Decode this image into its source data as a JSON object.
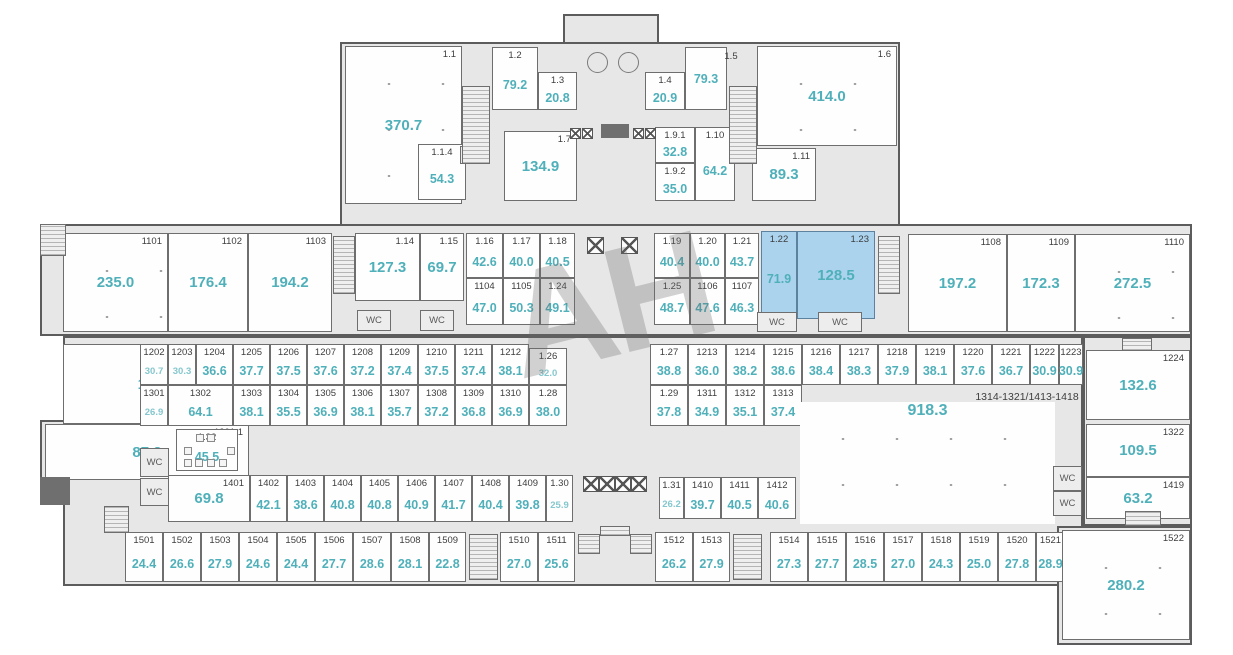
{
  "watermark": {
    "text": "АН"
  },
  "labels": {
    "wc": "WC"
  },
  "colors": {
    "area_text": "#4fb0ba",
    "area_text_small": "#85c7ce",
    "room_number_text": "#3d3d3d",
    "highlight_fill": "#abd3ee",
    "building_fill": "#e7e7e7",
    "wall": "#5c5c5c",
    "room_fill": "#fefefe"
  },
  "notes": [
    {
      "text": "1314-1321/1413-1418",
      "x": 1027,
      "y": 397
    }
  ],
  "base_shapes": [
    {
      "x": 563,
      "y": 14,
      "w": 96,
      "h": 34
    },
    {
      "x": 340,
      "y": 42,
      "w": 560,
      "h": 184
    },
    {
      "x": 40,
      "y": 224,
      "w": 1152,
      "h": 112
    },
    {
      "x": 63,
      "y": 336,
      "w": 1020,
      "h": 250
    },
    {
      "x": 1083,
      "y": 336,
      "w": 109,
      "h": 190
    },
    {
      "x": 1057,
      "y": 526,
      "w": 135,
      "h": 119
    },
    {
      "x": 40,
      "y": 420,
      "w": 30,
      "h": 85
    }
  ],
  "rooms": [
    {
      "n": "1.1",
      "a": "370.7",
      "x": 345,
      "y": 46,
      "w": 117,
      "h": 158,
      "s": "hall",
      "dots": true
    },
    {
      "n": "1.2",
      "a": "79.2",
      "x": 492,
      "y": 47,
      "w": 46,
      "h": 63,
      "s": "cell"
    },
    {
      "n": "1.3",
      "a": "20.8",
      "x": 538,
      "y": 72,
      "w": 39,
      "h": 38,
      "s": "cell"
    },
    {
      "n": "1.4",
      "a": "20.9",
      "x": 645,
      "y": 72,
      "w": 40,
      "h": 38,
      "s": "cell"
    },
    {
      "n": "",
      "a": "79.3",
      "x": 685,
      "y": 47,
      "w": 42,
      "h": 63,
      "s": "cell"
    },
    {
      "n": "1.5",
      "a": "",
      "x": 716,
      "y": 51,
      "w": 30,
      "h": 13,
      "s": "label"
    },
    {
      "n": "1.6",
      "a": "414.0",
      "x": 757,
      "y": 46,
      "w": 140,
      "h": 100,
      "s": "hall",
      "dots": true
    },
    {
      "n": "1.1.4",
      "a": "54.3",
      "x": 418,
      "y": 144,
      "w": 48,
      "h": 56,
      "s": "cell"
    },
    {
      "n": "1.7",
      "a": "134.9",
      "x": 504,
      "y": 131,
      "w": 73,
      "h": 70,
      "s": "hall"
    },
    {
      "n": "1.9.1",
      "a": "32.8",
      "x": 655,
      "y": 127,
      "w": 40,
      "h": 36,
      "s": "cell"
    },
    {
      "n": "1.9.2",
      "a": "35.0",
      "x": 655,
      "y": 163,
      "w": 40,
      "h": 38,
      "s": "cell"
    },
    {
      "n": "1.10",
      "a": "64.2",
      "x": 695,
      "y": 127,
      "w": 40,
      "h": 74,
      "s": "cell"
    },
    {
      "n": "1.11",
      "a": "89.3",
      "x": 752,
      "y": 148,
      "w": 64,
      "h": 53,
      "s": "hall"
    },
    {
      "n": "1101",
      "a": "235.0",
      "x": 63,
      "y": 233,
      "w": 105,
      "h": 99,
      "s": "hall",
      "dots": true
    },
    {
      "n": "1102",
      "a": "176.4",
      "x": 168,
      "y": 233,
      "w": 80,
      "h": 99,
      "s": "hall"
    },
    {
      "n": "1103",
      "a": "194.2",
      "x": 248,
      "y": 233,
      "w": 84,
      "h": 99,
      "s": "hall"
    },
    {
      "n": "1.14",
      "a": "127.3",
      "x": 355,
      "y": 233,
      "w": 65,
      "h": 68,
      "s": "hall"
    },
    {
      "n": "1.15",
      "a": "69.7",
      "x": 420,
      "y": 233,
      "w": 44,
      "h": 68,
      "s": "hall"
    },
    {
      "n": "1.16",
      "a": "42.6",
      "x": 466,
      "y": 233,
      "w": 37,
      "h": 45,
      "s": "cell"
    },
    {
      "n": "1.17",
      "a": "40.0",
      "x": 503,
      "y": 233,
      "w": 37,
      "h": 45,
      "s": "cell"
    },
    {
      "n": "1.18",
      "a": "40.5",
      "x": 540,
      "y": 233,
      "w": 35,
      "h": 45,
      "s": "cell"
    },
    {
      "n": "1104",
      "a": "47.0",
      "x": 466,
      "y": 278,
      "w": 37,
      "h": 47,
      "s": "cell"
    },
    {
      "n": "1105",
      "a": "50.3",
      "x": 503,
      "y": 278,
      "w": 37,
      "h": 47,
      "s": "cell"
    },
    {
      "n": "1.24",
      "a": "49.1",
      "x": 540,
      "y": 278,
      "w": 35,
      "h": 47,
      "s": "cell"
    },
    {
      "n": "1.19",
      "a": "40.4",
      "x": 654,
      "y": 233,
      "w": 36,
      "h": 45,
      "s": "cell"
    },
    {
      "n": "1.20",
      "a": "40.0",
      "x": 690,
      "y": 233,
      "w": 35,
      "h": 45,
      "s": "cell"
    },
    {
      "n": "1.21",
      "a": "43.7",
      "x": 725,
      "y": 233,
      "w": 34,
      "h": 45,
      "s": "cell"
    },
    {
      "n": "1.22",
      "a": "71.9",
      "x": 761,
      "y": 231,
      "w": 36,
      "h": 82,
      "s": "cell",
      "hl": true
    },
    {
      "n": "1.23",
      "a": "128.5",
      "x": 797,
      "y": 231,
      "w": 78,
      "h": 88,
      "s": "hall",
      "hl": true
    },
    {
      "n": "1.25",
      "a": "48.7",
      "x": 654,
      "y": 278,
      "w": 36,
      "h": 47,
      "s": "cell"
    },
    {
      "n": "1106",
      "a": "47.6",
      "x": 690,
      "y": 278,
      "w": 35,
      "h": 47,
      "s": "cell"
    },
    {
      "n": "1107",
      "a": "46.3",
      "x": 725,
      "y": 278,
      "w": 34,
      "h": 47,
      "s": "cell"
    },
    {
      "n": "1108",
      "a": "197.2",
      "x": 908,
      "y": 234,
      "w": 99,
      "h": 98,
      "s": "hall"
    },
    {
      "n": "1109",
      "a": "172.3",
      "x": 1007,
      "y": 234,
      "w": 68,
      "h": 98,
      "s": "hall"
    },
    {
      "n": "1110",
      "a": "272.5",
      "x": 1075,
      "y": 234,
      "w": 115,
      "h": 98,
      "s": "hall",
      "dots": true
    },
    {
      "n": "1201",
      "a": "117.8",
      "x": 63,
      "y": 344,
      "w": 186,
      "h": 80,
      "s": "hall"
    },
    {
      "n": "1201.1",
      "a": "87.2",
      "x": 45,
      "y": 424,
      "w": 204,
      "h": 56,
      "s": "hall"
    },
    {
      "n": "1202",
      "a": "30.7",
      "x": 140,
      "y": 344,
      "w": 28,
      "h": 41,
      "s": "cell",
      "small": true
    },
    {
      "n": "1203",
      "a": "30.3",
      "x": 168,
      "y": 344,
      "w": 28,
      "h": 41,
      "s": "cell",
      "small": true
    },
    {
      "n": "1204",
      "a": "36.6",
      "x": 196,
      "y": 344,
      "w": 37,
      "h": 41,
      "s": "cell"
    },
    {
      "n": "1205",
      "a": "37.7",
      "x": 233,
      "y": 344,
      "w": 37,
      "h": 41,
      "s": "cell"
    },
    {
      "n": "1206",
      "a": "37.5",
      "x": 270,
      "y": 344,
      "w": 37,
      "h": 41,
      "s": "cell"
    },
    {
      "n": "1207",
      "a": "37.6",
      "x": 307,
      "y": 344,
      "w": 37,
      "h": 41,
      "s": "cell"
    },
    {
      "n": "1208",
      "a": "37.2",
      "x": 344,
      "y": 344,
      "w": 37,
      "h": 41,
      "s": "cell"
    },
    {
      "n": "1209",
      "a": "37.4",
      "x": 381,
      "y": 344,
      "w": 37,
      "h": 41,
      "s": "cell"
    },
    {
      "n": "1210",
      "a": "37.5",
      "x": 418,
      "y": 344,
      "w": 37,
      "h": 41,
      "s": "cell"
    },
    {
      "n": "1211",
      "a": "37.4",
      "x": 455,
      "y": 344,
      "w": 37,
      "h": 41,
      "s": "cell"
    },
    {
      "n": "1212",
      "a": "38.1",
      "x": 492,
      "y": 344,
      "w": 37,
      "h": 41,
      "s": "cell"
    },
    {
      "n": "1.26",
      "a": "32.0",
      "x": 529,
      "y": 348,
      "w": 38,
      "h": 37,
      "s": "cell",
      "small": true
    },
    {
      "n": "1301",
      "a": "26.9",
      "x": 140,
      "y": 385,
      "w": 28,
      "h": 41,
      "s": "cell",
      "small": true
    },
    {
      "n": "1302",
      "a": "64.1",
      "x": 168,
      "y": 385,
      "w": 65,
      "h": 41,
      "s": "cell"
    },
    {
      "n": "1303",
      "a": "38.1",
      "x": 233,
      "y": 385,
      "w": 37,
      "h": 41,
      "s": "cell"
    },
    {
      "n": "1304",
      "a": "35.5",
      "x": 270,
      "y": 385,
      "w": 37,
      "h": 41,
      "s": "cell"
    },
    {
      "n": "1305",
      "a": "36.9",
      "x": 307,
      "y": 385,
      "w": 37,
      "h": 41,
      "s": "cell"
    },
    {
      "n": "1306",
      "a": "38.1",
      "x": 344,
      "y": 385,
      "w": 37,
      "h": 41,
      "s": "cell"
    },
    {
      "n": "1307",
      "a": "35.7",
      "x": 381,
      "y": 385,
      "w": 37,
      "h": 41,
      "s": "cell"
    },
    {
      "n": "1308",
      "a": "37.2",
      "x": 418,
      "y": 385,
      "w": 37,
      "h": 41,
      "s": "cell"
    },
    {
      "n": "1309",
      "a": "36.8",
      "x": 455,
      "y": 385,
      "w": 37,
      "h": 41,
      "s": "cell"
    },
    {
      "n": "1310",
      "a": "36.9",
      "x": 492,
      "y": 385,
      "w": 37,
      "h": 41,
      "s": "cell"
    },
    {
      "n": "1.28",
      "a": "38.0",
      "x": 529,
      "y": 385,
      "w": 38,
      "h": 41,
      "s": "cell"
    },
    {
      "n": "1.27",
      "a": "38.8",
      "x": 650,
      "y": 344,
      "w": 38,
      "h": 41,
      "s": "cell"
    },
    {
      "n": "1213",
      "a": "36.0",
      "x": 688,
      "y": 344,
      "w": 38,
      "h": 41,
      "s": "cell"
    },
    {
      "n": "1214",
      "a": "38.2",
      "x": 726,
      "y": 344,
      "w": 38,
      "h": 41,
      "s": "cell"
    },
    {
      "n": "1215",
      "a": "38.6",
      "x": 764,
      "y": 344,
      "w": 38,
      "h": 41,
      "s": "cell"
    },
    {
      "n": "1216",
      "a": "38.4",
      "x": 802,
      "y": 344,
      "w": 38,
      "h": 41,
      "s": "cell"
    },
    {
      "n": "1217",
      "a": "38.3",
      "x": 840,
      "y": 344,
      "w": 38,
      "h": 41,
      "s": "cell"
    },
    {
      "n": "1218",
      "a": "37.9",
      "x": 878,
      "y": 344,
      "w": 38,
      "h": 41,
      "s": "cell"
    },
    {
      "n": "1219",
      "a": "38.1",
      "x": 916,
      "y": 344,
      "w": 38,
      "h": 41,
      "s": "cell"
    },
    {
      "n": "1220",
      "a": "37.6",
      "x": 954,
      "y": 344,
      "w": 38,
      "h": 41,
      "s": "cell"
    },
    {
      "n": "1221",
      "a": "36.7",
      "x": 992,
      "y": 344,
      "w": 38,
      "h": 41,
      "s": "cell"
    },
    {
      "n": "1222",
      "a": "30.9",
      "x": 1030,
      "y": 344,
      "w": 29,
      "h": 41,
      "s": "cell"
    },
    {
      "n": "1223",
      "a": "30.9",
      "x": 1059,
      "y": 344,
      "w": 24,
      "h": 41,
      "s": "cell"
    },
    {
      "n": "1.29",
      "a": "37.8",
      "x": 650,
      "y": 385,
      "w": 38,
      "h": 41,
      "s": "cell"
    },
    {
      "n": "1311",
      "a": "34.9",
      "x": 688,
      "y": 385,
      "w": 38,
      "h": 41,
      "s": "cell"
    },
    {
      "n": "1312",
      "a": "35.1",
      "x": 726,
      "y": 385,
      "w": 38,
      "h": 41,
      "s": "cell"
    },
    {
      "n": "1313",
      "a": "37.4",
      "x": 764,
      "y": 385,
      "w": 38,
      "h": 41,
      "s": "cell"
    },
    {
      "n": "",
      "a": "918.3",
      "x": 800,
      "y": 402,
      "w": 255,
      "h": 122,
      "s": "open",
      "dots": true
    },
    {
      "n": "1224",
      "a": "132.6",
      "x": 1086,
      "y": 350,
      "w": 104,
      "h": 70,
      "s": "hall"
    },
    {
      "n": "1322",
      "a": "109.5",
      "x": 1086,
      "y": 424,
      "w": 104,
      "h": 53,
      "s": "hall"
    },
    {
      "n": "1419",
      "a": "63.2",
      "x": 1086,
      "y": 477,
      "w": 104,
      "h": 42,
      "s": "hall"
    },
    {
      "n": "1.32",
      "a": "45.5",
      "x": 176,
      "y": 429,
      "w": 62,
      "h": 42,
      "s": "cell"
    },
    {
      "n": "1401",
      "a": "69.8",
      "x": 168,
      "y": 475,
      "w": 82,
      "h": 47,
      "s": "hall"
    },
    {
      "n": "1402",
      "a": "42.1",
      "x": 250,
      "y": 475,
      "w": 37,
      "h": 47,
      "s": "cell"
    },
    {
      "n": "1403",
      "a": "38.6",
      "x": 287,
      "y": 475,
      "w": 37,
      "h": 47,
      "s": "cell"
    },
    {
      "n": "1404",
      "a": "40.8",
      "x": 324,
      "y": 475,
      "w": 37,
      "h": 47,
      "s": "cell"
    },
    {
      "n": "1405",
      "a": "40.8",
      "x": 361,
      "y": 475,
      "w": 37,
      "h": 47,
      "s": "cell"
    },
    {
      "n": "1406",
      "a": "40.9",
      "x": 398,
      "y": 475,
      "w": 37,
      "h": 47,
      "s": "cell"
    },
    {
      "n": "1407",
      "a": "41.7",
      "x": 435,
      "y": 475,
      "w": 37,
      "h": 47,
      "s": "cell"
    },
    {
      "n": "1408",
      "a": "40.4",
      "x": 472,
      "y": 475,
      "w": 37,
      "h": 47,
      "s": "cell"
    },
    {
      "n": "1409",
      "a": "39.8",
      "x": 509,
      "y": 475,
      "w": 37,
      "h": 47,
      "s": "cell"
    },
    {
      "n": "1.30",
      "a": "25.9",
      "x": 546,
      "y": 475,
      "w": 27,
      "h": 47,
      "s": "cell",
      "small": true
    },
    {
      "n": "1.31",
      "a": "26.2",
      "x": 659,
      "y": 477,
      "w": 25,
      "h": 42,
      "s": "cell",
      "small": true
    },
    {
      "n": "1410",
      "a": "39.7",
      "x": 684,
      "y": 477,
      "w": 37,
      "h": 42,
      "s": "cell"
    },
    {
      "n": "1411",
      "a": "40.5",
      "x": 721,
      "y": 477,
      "w": 37,
      "h": 42,
      "s": "cell"
    },
    {
      "n": "1412",
      "a": "40.6",
      "x": 758,
      "y": 477,
      "w": 38,
      "h": 42,
      "s": "cell"
    },
    {
      "n": "1501",
      "a": "24.4",
      "x": 125,
      "y": 532,
      "w": 38,
      "h": 50,
      "s": "cell"
    },
    {
      "n": "1502",
      "a": "26.6",
      "x": 163,
      "y": 532,
      "w": 38,
      "h": 50,
      "s": "cell"
    },
    {
      "n": "1503",
      "a": "27.9",
      "x": 201,
      "y": 532,
      "w": 38,
      "h": 50,
      "s": "cell"
    },
    {
      "n": "1504",
      "a": "24.6",
      "x": 239,
      "y": 532,
      "w": 38,
      "h": 50,
      "s": "cell"
    },
    {
      "n": "1505",
      "a": "24.4",
      "x": 277,
      "y": 532,
      "w": 38,
      "h": 50,
      "s": "cell"
    },
    {
      "n": "1506",
      "a": "27.7",
      "x": 315,
      "y": 532,
      "w": 38,
      "h": 50,
      "s": "cell"
    },
    {
      "n": "1507",
      "a": "28.6",
      "x": 353,
      "y": 532,
      "w": 38,
      "h": 50,
      "s": "cell"
    },
    {
      "n": "1508",
      "a": "28.1",
      "x": 391,
      "y": 532,
      "w": 38,
      "h": 50,
      "s": "cell"
    },
    {
      "n": "1509",
      "a": "22.8",
      "x": 429,
      "y": 532,
      "w": 37,
      "h": 50,
      "s": "cell"
    },
    {
      "n": "1510",
      "a": "27.0",
      "x": 500,
      "y": 532,
      "w": 38,
      "h": 50,
      "s": "cell"
    },
    {
      "n": "1511",
      "a": "25.6",
      "x": 538,
      "y": 532,
      "w": 37,
      "h": 50,
      "s": "cell"
    },
    {
      "n": "1512",
      "a": "26.2",
      "x": 655,
      "y": 532,
      "w": 38,
      "h": 50,
      "s": "cell"
    },
    {
      "n": "1513",
      "a": "27.9",
      "x": 693,
      "y": 532,
      "w": 37,
      "h": 50,
      "s": "cell"
    },
    {
      "n": "1514",
      "a": "27.3",
      "x": 770,
      "y": 532,
      "w": 38,
      "h": 50,
      "s": "cell"
    },
    {
      "n": "1515",
      "a": "27.7",
      "x": 808,
      "y": 532,
      "w": 38,
      "h": 50,
      "s": "cell"
    },
    {
      "n": "1516",
      "a": "28.5",
      "x": 846,
      "y": 532,
      "w": 38,
      "h": 50,
      "s": "cell"
    },
    {
      "n": "1517",
      "a": "27.0",
      "x": 884,
      "y": 532,
      "w": 38,
      "h": 50,
      "s": "cell"
    },
    {
      "n": "1518",
      "a": "24.3",
      "x": 922,
      "y": 532,
      "w": 38,
      "h": 50,
      "s": "cell"
    },
    {
      "n": "1519",
      "a": "25.0",
      "x": 960,
      "y": 532,
      "w": 38,
      "h": 50,
      "s": "cell"
    },
    {
      "n": "1520",
      "a": "27.8",
      "x": 998,
      "y": 532,
      "w": 38,
      "h": 50,
      "s": "cell"
    },
    {
      "n": "1521",
      "a": "28.9",
      "x": 1036,
      "y": 532,
      "w": 29,
      "h": 50,
      "s": "cell"
    },
    {
      "n": "1522",
      "a": "280.2",
      "x": 1062,
      "y": 530,
      "w": 128,
      "h": 110,
      "s": "hall",
      "dots": true
    }
  ],
  "wc_rooms": [
    {
      "x": 460,
      "y": 146,
      "w": 26,
      "h": 18
    },
    {
      "x": 730,
      "y": 146,
      "w": 26,
      "h": 18
    },
    {
      "x": 357,
      "y": 310,
      "w": 34,
      "h": 21
    },
    {
      "x": 420,
      "y": 310,
      "w": 34,
      "h": 21
    },
    {
      "x": 757,
      "y": 312,
      "w": 40,
      "h": 20
    },
    {
      "x": 818,
      "y": 312,
      "w": 44,
      "h": 20
    },
    {
      "x": 140,
      "y": 448,
      "w": 29,
      "h": 29
    },
    {
      "x": 140,
      "y": 478,
      "w": 29,
      "h": 28
    },
    {
      "x": 1053,
      "y": 466,
      "w": 29,
      "h": 25
    },
    {
      "x": 1053,
      "y": 491,
      "w": 29,
      "h": 25
    }
  ],
  "hatches": [
    {
      "x": 462,
      "y": 86,
      "w": 28,
      "h": 78
    },
    {
      "x": 729,
      "y": 86,
      "w": 28,
      "h": 78
    },
    {
      "x": 40,
      "y": 224,
      "w": 26,
      "h": 32
    },
    {
      "x": 333,
      "y": 236,
      "w": 22,
      "h": 58
    },
    {
      "x": 878,
      "y": 236,
      "w": 22,
      "h": 58
    },
    {
      "x": 104,
      "y": 506,
      "w": 25,
      "h": 27
    },
    {
      "x": 1122,
      "y": 338,
      "w": 30,
      "h": 13
    },
    {
      "x": 1125,
      "y": 511,
      "w": 36,
      "h": 15
    },
    {
      "x": 469,
      "y": 534,
      "w": 29,
      "h": 46
    },
    {
      "x": 733,
      "y": 534,
      "w": 29,
      "h": 46
    },
    {
      "x": 578,
      "y": 534,
      "w": 22,
      "h": 20
    },
    {
      "x": 630,
      "y": 534,
      "w": 22,
      "h": 20
    },
    {
      "x": 600,
      "y": 526,
      "w": 30,
      "h": 10
    }
  ],
  "elevators": [
    {
      "x": 587,
      "y": 237,
      "s": 17
    },
    {
      "x": 621,
      "y": 237,
      "s": 17
    },
    {
      "x": 583,
      "y": 476,
      "s": 16
    },
    {
      "x": 599,
      "y": 476,
      "s": 16
    },
    {
      "x": 615,
      "y": 476,
      "s": 16
    },
    {
      "x": 631,
      "y": 476,
      "s": 16
    },
    {
      "x": 570,
      "y": 128,
      "s": 11
    },
    {
      "x": 582,
      "y": 128,
      "s": 11
    },
    {
      "x": 633,
      "y": 128,
      "s": 11
    },
    {
      "x": 645,
      "y": 128,
      "s": 11
    }
  ],
  "circles": [
    {
      "x": 587,
      "y": 52,
      "s": 21
    },
    {
      "x": 618,
      "y": 52,
      "s": 21
    }
  ],
  "dark_blocks": [
    {
      "x": 40,
      "y": 477,
      "w": 30,
      "h": 28
    },
    {
      "x": 601,
      "y": 124,
      "w": 28,
      "h": 14
    }
  ],
  "seats": [
    {
      "x": 196,
      "y": 434
    },
    {
      "x": 207,
      "y": 434
    },
    {
      "x": 184,
      "y": 447
    },
    {
      "x": 227,
      "y": 447
    },
    {
      "x": 184,
      "y": 459
    },
    {
      "x": 195,
      "y": 459
    },
    {
      "x": 207,
      "y": 459
    },
    {
      "x": 219,
      "y": 459
    }
  ]
}
